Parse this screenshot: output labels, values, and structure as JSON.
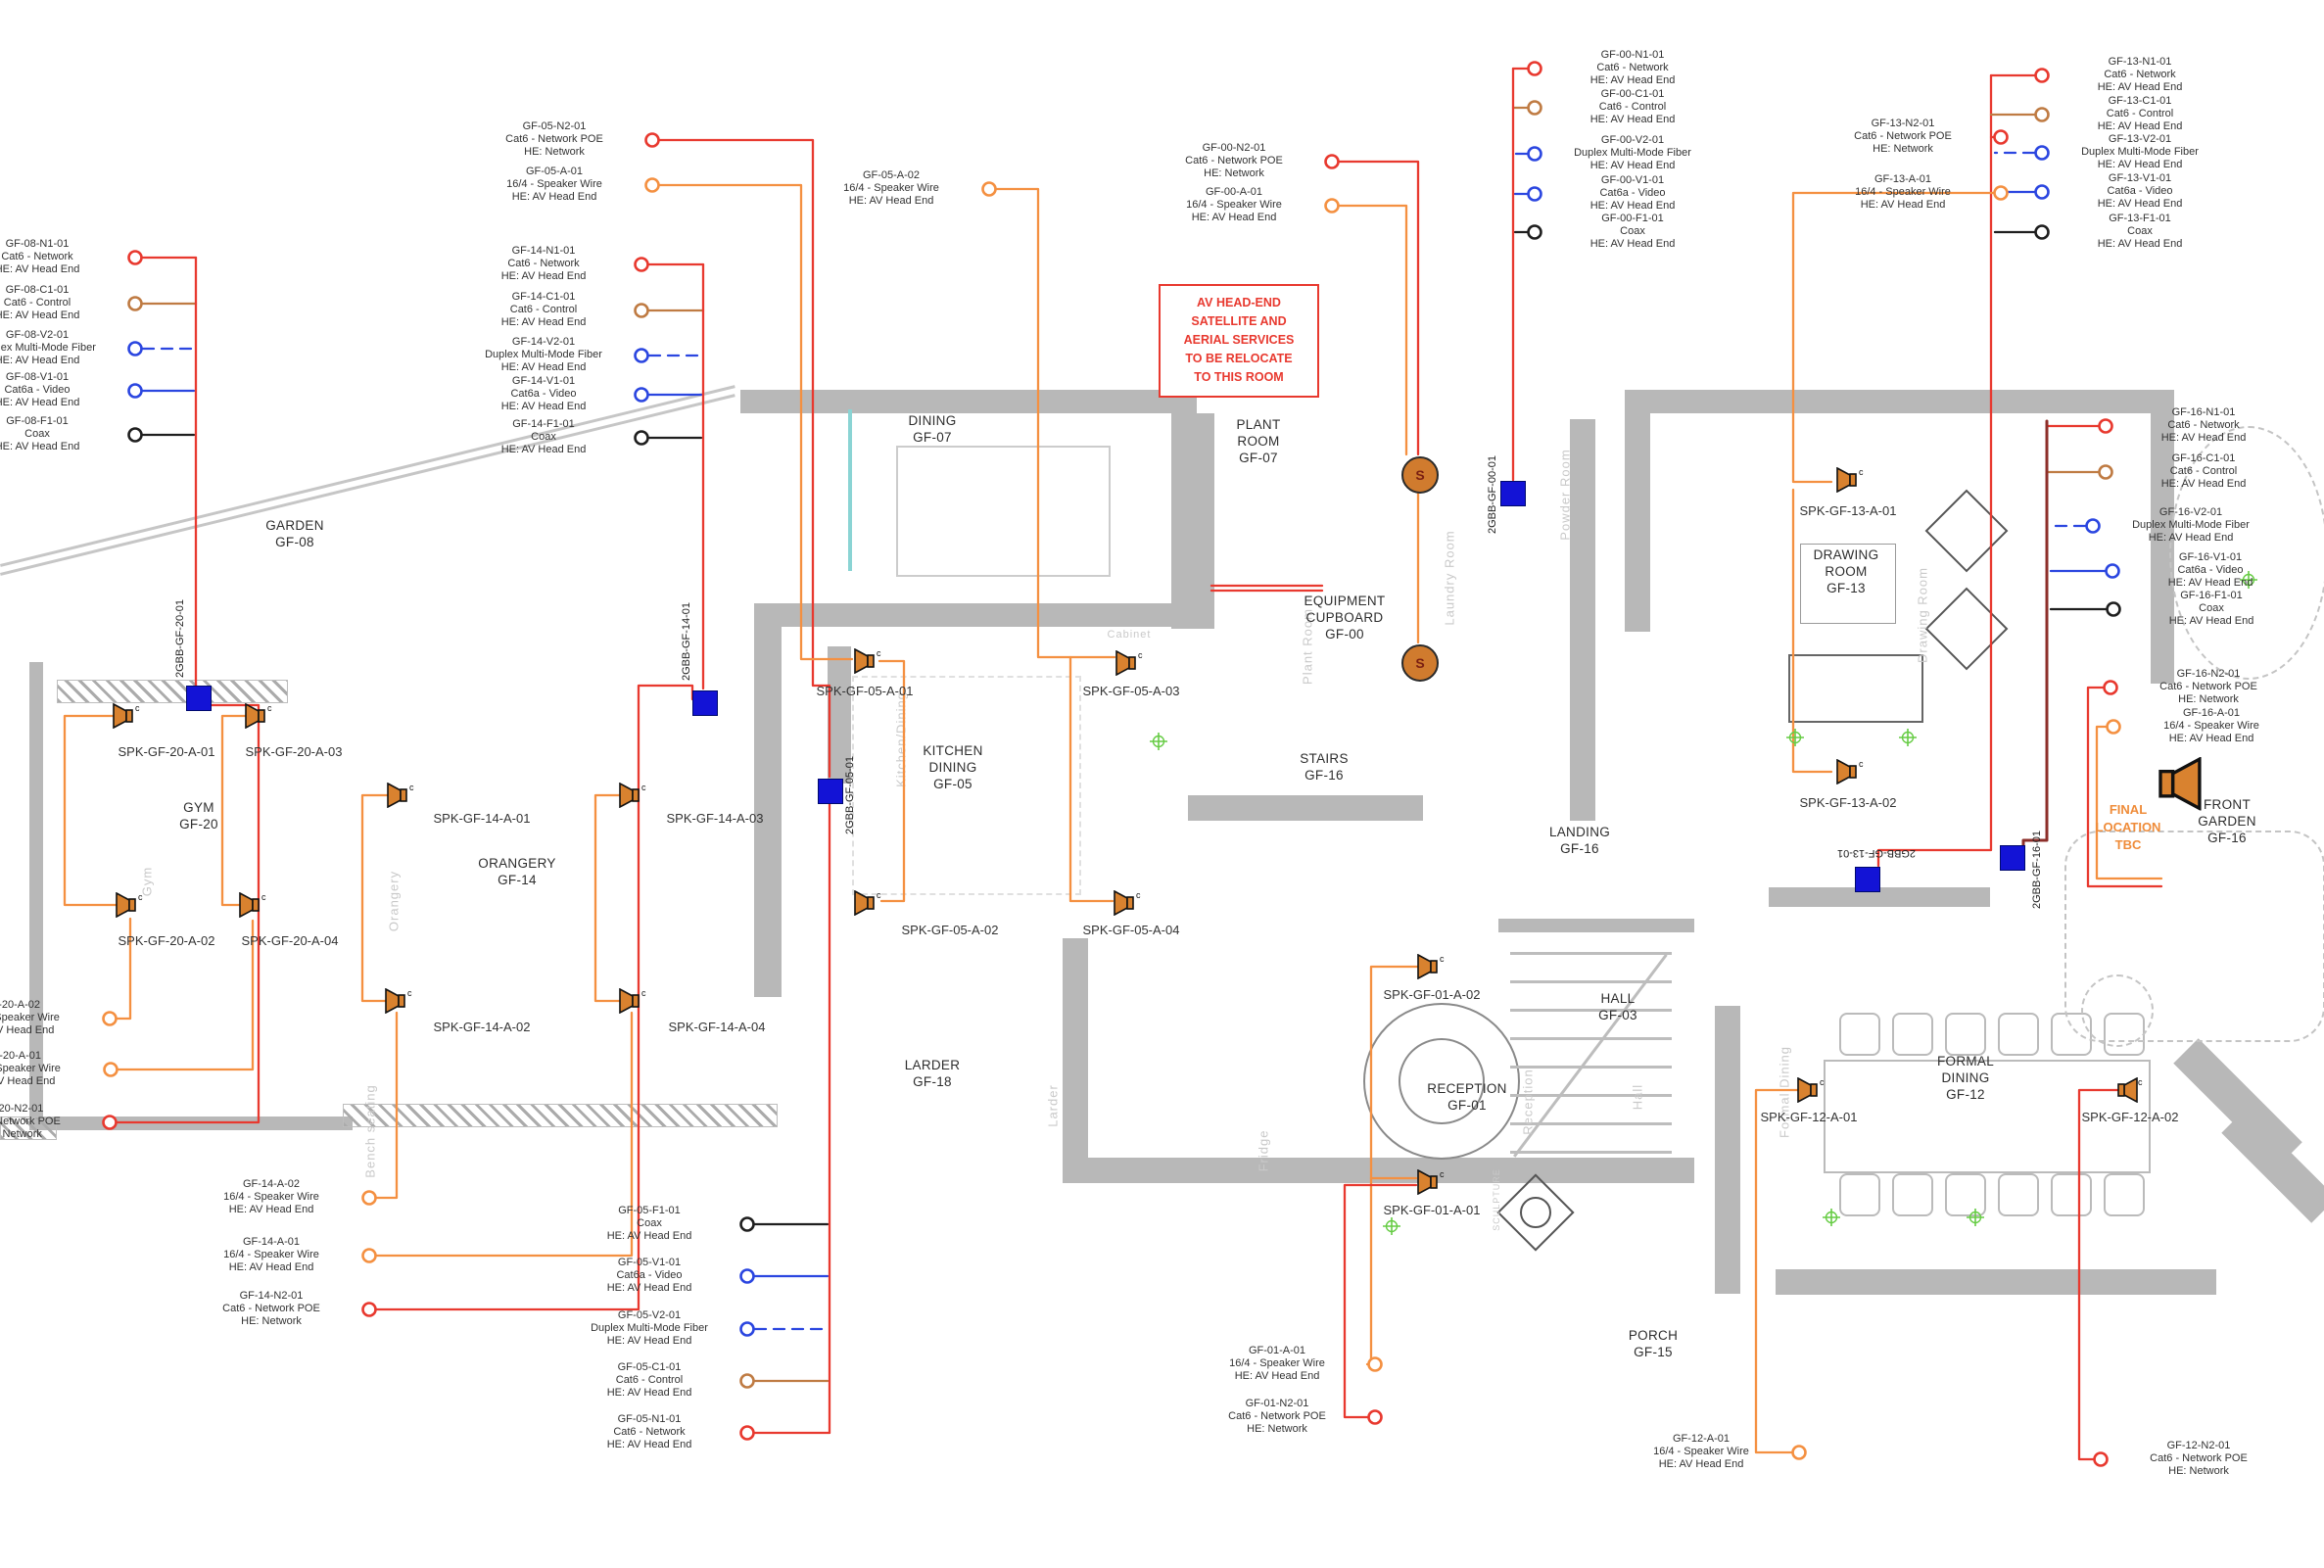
{
  "note": {
    "lines": [
      "AV HEAD-END",
      "SATELLITE AND",
      "AERIAL SERVICES",
      "TO BE RELOCATE",
      "TO THIS ROOM"
    ]
  },
  "final_location": {
    "lines": [
      "FINAL",
      "LOCATION",
      "TBC"
    ]
  },
  "colors": {
    "network": "#e8392f",
    "control": "#bf7b43",
    "fiber": "#2b46e0",
    "video": "#2b46e0",
    "coax": "#1f1f1f",
    "speaker_wire": "#f49041",
    "speaker_icon": "#d9822f",
    "keypad_blue": "#1313d6",
    "trunk_maroon": "#8d2f2a",
    "note_red": "#e8392f",
    "tbc_orange": "#ef8c3a",
    "marker_green": "#66cc44",
    "wall_gray": "#b8b8b8",
    "faint_gray": "#c9c9c9",
    "teal_window": "#8ad4d4"
  },
  "callouts": [
    {
      "id": "gf08n1",
      "color": "network",
      "lines": [
        "GF-08-N1-01",
        "Cat6 - Network",
        "HE: AV Head End"
      ]
    },
    {
      "id": "gf08c1",
      "color": "control",
      "lines": [
        "GF-08-C1-01",
        "Cat6 - Control",
        "HE: AV Head End"
      ]
    },
    {
      "id": "gf08v2",
      "color": "fiber",
      "lines": [
        "GF-08-V2-01",
        "Duplex Multi-Mode Fiber",
        "HE: AV Head End"
      ]
    },
    {
      "id": "gf08v1",
      "color": "video",
      "lines": [
        "GF-08-V1-01",
        "Cat6a - Video",
        "HE: AV Head End"
      ]
    },
    {
      "id": "gf08f1",
      "color": "coax",
      "lines": [
        "GF-08-F1-01",
        "Coax",
        "HE: AV Head End"
      ]
    },
    {
      "id": "gf05n2",
      "color": "network",
      "lines": [
        "GF-05-N2-01",
        "Cat6 - Network POE",
        "HE: Network"
      ]
    },
    {
      "id": "gf05a1",
      "color": "speaker_wire",
      "lines": [
        "GF-05-A-01",
        "16/4 - Speaker Wire",
        "HE: AV Head End"
      ]
    },
    {
      "id": "gf05a2",
      "color": "speaker_wire",
      "lines": [
        "GF-05-A-02",
        "16/4 - Speaker Wire",
        "HE: AV Head End"
      ]
    },
    {
      "id": "gf14n1",
      "color": "network",
      "lines": [
        "GF-14-N1-01",
        "Cat6 - Network",
        "HE: AV Head End"
      ]
    },
    {
      "id": "gf14c1",
      "color": "control",
      "lines": [
        "GF-14-C1-01",
        "Cat6 - Control",
        "HE: AV Head End"
      ]
    },
    {
      "id": "gf14v2",
      "color": "fiber",
      "lines": [
        "GF-14-V2-01",
        "Duplex Multi-Mode Fiber",
        "HE: AV Head End"
      ]
    },
    {
      "id": "gf14v1",
      "color": "video",
      "lines": [
        "GF-14-V1-01",
        "Cat6a - Video",
        "HE: AV Head End"
      ]
    },
    {
      "id": "gf14f1",
      "color": "coax",
      "lines": [
        "GF-14-F1-01",
        "Coax",
        "HE: AV Head End"
      ]
    },
    {
      "id": "gf00n2",
      "color": "network",
      "lines": [
        "GF-00-N2-01",
        "Cat6 - Network POE",
        "HE: Network"
      ]
    },
    {
      "id": "gf00a1",
      "color": "speaker_wire",
      "lines": [
        "GF-00-A-01",
        "16/4 - Speaker Wire",
        "HE: AV Head End"
      ]
    },
    {
      "id": "gf00n1",
      "color": "network",
      "lines": [
        "GF-00-N1-01",
        "Cat6 - Network",
        "HE: AV Head End"
      ]
    },
    {
      "id": "gf00c1",
      "color": "control",
      "lines": [
        "GF-00-C1-01",
        "Cat6 - Control",
        "HE: AV Head End"
      ]
    },
    {
      "id": "gf00v2",
      "color": "fiber",
      "lines": [
        "GF-00-V2-01",
        "Duplex Multi-Mode Fiber",
        "HE: AV Head End"
      ]
    },
    {
      "id": "gf00v1",
      "color": "video",
      "lines": [
        "GF-00-V1-01",
        "Cat6a - Video",
        "HE: AV Head End"
      ]
    },
    {
      "id": "gf00f1",
      "color": "coax",
      "lines": [
        "GF-00-F1-01",
        "Coax",
        "HE: AV Head End"
      ]
    },
    {
      "id": "gf13n2",
      "color": "network",
      "lines": [
        "GF-13-N2-01",
        "Cat6 - Network POE",
        "HE: Network"
      ]
    },
    {
      "id": "gf13a1",
      "color": "speaker_wire",
      "lines": [
        "GF-13-A-01",
        "16/4 - Speaker Wire",
        "HE: AV Head End"
      ]
    },
    {
      "id": "gf13n1",
      "color": "network",
      "lines": [
        "GF-13-N1-01",
        "Cat6 - Network",
        "HE: AV Head End"
      ]
    },
    {
      "id": "gf13c1",
      "color": "control",
      "lines": [
        "GF-13-C1-01",
        "Cat6 - Control",
        "HE: AV Head End"
      ]
    },
    {
      "id": "gf13v2",
      "color": "fiber",
      "lines": [
        "GF-13-V2-01",
        "Duplex Multi-Mode Fiber",
        "HE: AV Head End"
      ]
    },
    {
      "id": "gf13v1",
      "color": "video",
      "lines": [
        "GF-13-V1-01",
        "Cat6a - Video",
        "HE: AV Head End"
      ]
    },
    {
      "id": "gf13f1",
      "color": "coax",
      "lines": [
        "GF-13-F1-01",
        "Coax",
        "HE: AV Head End"
      ]
    },
    {
      "id": "gf16n1",
      "color": "network",
      "lines": [
        "GF-16-N1-01",
        "Cat6 - Network",
        "HE: AV Head End"
      ]
    },
    {
      "id": "gf16c1",
      "color": "control",
      "lines": [
        "GF-16-C1-01",
        "Cat6 - Control",
        "HE: AV Head End"
      ]
    },
    {
      "id": "gf16v2",
      "color": "fiber",
      "lines": [
        "GF-16-V2-01",
        "Duplex Multi-Mode Fiber",
        "HE: AV Head End"
      ]
    },
    {
      "id": "gf16v1",
      "color": "video",
      "lines": [
        "GF-16-V1-01",
        "Cat6a - Video",
        "HE: AV Head End"
      ]
    },
    {
      "id": "gf16f1",
      "color": "coax",
      "lines": [
        "GF-16-F1-01",
        "Coax",
        "HE: AV Head End"
      ]
    },
    {
      "id": "gf16n2",
      "color": "network",
      "lines": [
        "GF-16-N2-01",
        "Cat6 - Network POE",
        "HE: Network"
      ]
    },
    {
      "id": "gf16a1",
      "color": "speaker_wire",
      "lines": [
        "GF-16-A-01",
        "16/4 - Speaker Wire",
        "HE: AV Head End"
      ]
    },
    {
      "id": "gf20a2",
      "color": "speaker_wire",
      "lines": [
        "GF-20-A-02",
        "16/4 - Speaker Wire",
        "HE: AV Head End"
      ]
    },
    {
      "id": "gf20a1",
      "color": "speaker_wire",
      "lines": [
        "GF-20-A-01",
        "16/4 - Speaker Wire",
        "HE: AV Head End"
      ]
    },
    {
      "id": "gf20n2",
      "color": "network",
      "lines": [
        "GF-20-N2-01",
        "Cat6 - Network POE",
        "HE: Network"
      ]
    },
    {
      "id": "gf14a2b",
      "color": "speaker_wire",
      "lines": [
        "GF-14-A-02",
        "16/4 - Speaker Wire",
        "HE: AV Head End"
      ]
    },
    {
      "id": "gf14a1b",
      "color": "speaker_wire",
      "lines": [
        "GF-14-A-01",
        "16/4 - Speaker Wire",
        "HE: AV Head End"
      ]
    },
    {
      "id": "gf14n2b",
      "color": "network",
      "lines": [
        "GF-14-N2-01",
        "Cat6 - Network POE",
        "HE: Network"
      ]
    },
    {
      "id": "gf05f1b",
      "color": "coax",
      "lines": [
        "GF-05-F1-01",
        "Coax",
        "HE: AV Head End"
      ]
    },
    {
      "id": "gf05v1b",
      "color": "video",
      "lines": [
        "GF-05-V1-01",
        "Cat6a - Video",
        "HE: AV Head End"
      ]
    },
    {
      "id": "gf05v2b",
      "color": "fiber",
      "lines": [
        "GF-05-V2-01",
        "Duplex Multi-Mode Fiber",
        "HE: AV Head End"
      ]
    },
    {
      "id": "gf05c1b",
      "color": "control",
      "lines": [
        "GF-05-C1-01",
        "Cat6 - Control",
        "HE: AV Head End"
      ]
    },
    {
      "id": "gf05n1b",
      "color": "network",
      "lines": [
        "GF-05-N1-01",
        "Cat6 - Network",
        "HE: AV Head End"
      ]
    },
    {
      "id": "gf01a1",
      "color": "speaker_wire",
      "lines": [
        "GF-01-A-01",
        "16/4 - Speaker Wire",
        "HE: AV Head End"
      ]
    },
    {
      "id": "gf01n2",
      "color": "network",
      "lines": [
        "GF-01-N2-01",
        "Cat6 - Network POE",
        "HE: Network"
      ]
    },
    {
      "id": "gf12a1",
      "color": "speaker_wire",
      "lines": [
        "GF-12-A-01",
        "16/4 - Speaker Wire",
        "HE: AV Head End"
      ]
    },
    {
      "id": "gf12n2",
      "color": "network",
      "lines": [
        "GF-12-N2-01",
        "Cat6 - Network POE",
        "HE: Network"
      ]
    }
  ],
  "rooms": [
    {
      "id": "garden",
      "lines": [
        "GARDEN",
        "GF-08"
      ]
    },
    {
      "id": "gym",
      "lines": [
        "GYM",
        "GF-20"
      ]
    },
    {
      "id": "orangery",
      "lines": [
        "ORANGERY",
        "GF-14"
      ]
    },
    {
      "id": "dining",
      "lines": [
        "DINING",
        "GF-07"
      ]
    },
    {
      "id": "kitchen",
      "lines": [
        "KITCHEN",
        "DINING",
        "GF-05"
      ]
    },
    {
      "id": "larder",
      "lines": [
        "LARDER",
        "GF-18"
      ]
    },
    {
      "id": "plant",
      "lines": [
        "PLANT",
        "ROOM",
        "GF-07"
      ]
    },
    {
      "id": "equip",
      "lines": [
        "EQUIPMENT",
        "CUPBOARD",
        "GF-00"
      ]
    },
    {
      "id": "stairs",
      "lines": [
        "STAIRS",
        "GF-16"
      ]
    },
    {
      "id": "landing",
      "lines": [
        "LANDING",
        "GF-16"
      ]
    },
    {
      "id": "hall",
      "lines": [
        "HALL",
        "GF-03"
      ]
    },
    {
      "id": "reception",
      "lines": [
        "RECEPTION",
        "GF-01"
      ]
    },
    {
      "id": "porch",
      "lines": [
        "PORCH",
        "GF-15"
      ]
    },
    {
      "id": "drawing",
      "lines": [
        "DRAWING",
        "ROOM",
        "GF-13"
      ]
    },
    {
      "id": "formal",
      "lines": [
        "FORMAL",
        "DINING",
        "GF-12"
      ]
    },
    {
      "id": "frontgarden",
      "lines": [
        "FRONT",
        "GARDEN",
        "GF-16"
      ]
    }
  ],
  "faint_labels": [
    {
      "id": "plant-f",
      "text": "Plant Room"
    },
    {
      "id": "laundry-f",
      "text": "Laundry Room"
    },
    {
      "id": "kitchendining-f",
      "text": "Kitchen/Dining"
    },
    {
      "id": "orangery-f",
      "text": "Orangery"
    },
    {
      "id": "gym-f",
      "text": "Gym"
    },
    {
      "id": "reception-f",
      "text": "Reception"
    },
    {
      "id": "hall-f",
      "text": "Hall"
    },
    {
      "id": "drawing-f",
      "text": "Drawing Room"
    },
    {
      "id": "formal-f",
      "text": "Formal Dining"
    },
    {
      "id": "larder-f",
      "text": "Larder"
    },
    {
      "id": "fridge-f",
      "text": "Fridge"
    },
    {
      "id": "sculpture-f",
      "text": "SCULPTURE"
    },
    {
      "id": "powder-f",
      "text": "Powder Room"
    },
    {
      "id": "bench-f",
      "text": "Bench seating"
    },
    {
      "id": "cabinet-f",
      "text": "Cabinet"
    }
  ],
  "speakers": [
    {
      "id": "s20a1",
      "label": "SPK-GF-20-A-01"
    },
    {
      "id": "s20a3",
      "label": "SPK-GF-20-A-03"
    },
    {
      "id": "s20a2",
      "label": "SPK-GF-20-A-02"
    },
    {
      "id": "s20a4",
      "label": "SPK-GF-20-A-04"
    },
    {
      "id": "s14a1",
      "label": "SPK-GF-14-A-01"
    },
    {
      "id": "s14a3",
      "label": "SPK-GF-14-A-03"
    },
    {
      "id": "s14a2",
      "label": "SPK-GF-14-A-02"
    },
    {
      "id": "s14a4",
      "label": "SPK-GF-14-A-04"
    },
    {
      "id": "s05a1",
      "label": "SPK-GF-05-A-01"
    },
    {
      "id": "s05a3",
      "label": "SPK-GF-05-A-03"
    },
    {
      "id": "s05a2",
      "label": "SPK-GF-05-A-02"
    },
    {
      "id": "s05a4",
      "label": "SPK-GF-05-A-04"
    },
    {
      "id": "s13a1",
      "label": "SPK-GF-13-A-01"
    },
    {
      "id": "s13a2",
      "label": "SPK-GF-13-A-02"
    },
    {
      "id": "s01a2",
      "label": "SPK-GF-01-A-02"
    },
    {
      "id": "s01a1",
      "label": "SPK-GF-01-A-01"
    },
    {
      "id": "s12a1",
      "label": "SPK-GF-12-A-01"
    },
    {
      "id": "s12a2",
      "label": "SPK-GF-12-A-02"
    },
    {
      "id": "sbig",
      "label": ""
    }
  ],
  "keypads": [
    {
      "id": "kp20",
      "label": "2GBB-GF-20-01"
    },
    {
      "id": "kp14",
      "label": "2GBB-GF-14-01"
    },
    {
      "id": "kp05",
      "label": "2GBB-GF-05-01"
    },
    {
      "id": "kp00",
      "label": "2GBB-GF-00-01"
    },
    {
      "id": "kp13",
      "label": "2GBB-GF-13-01"
    },
    {
      "id": "kp16",
      "label": "2GBB-GF-16-01"
    }
  ],
  "s_nodes": [
    {
      "id": "s1",
      "label": "S"
    },
    {
      "id": "s2",
      "label": "S"
    }
  ]
}
